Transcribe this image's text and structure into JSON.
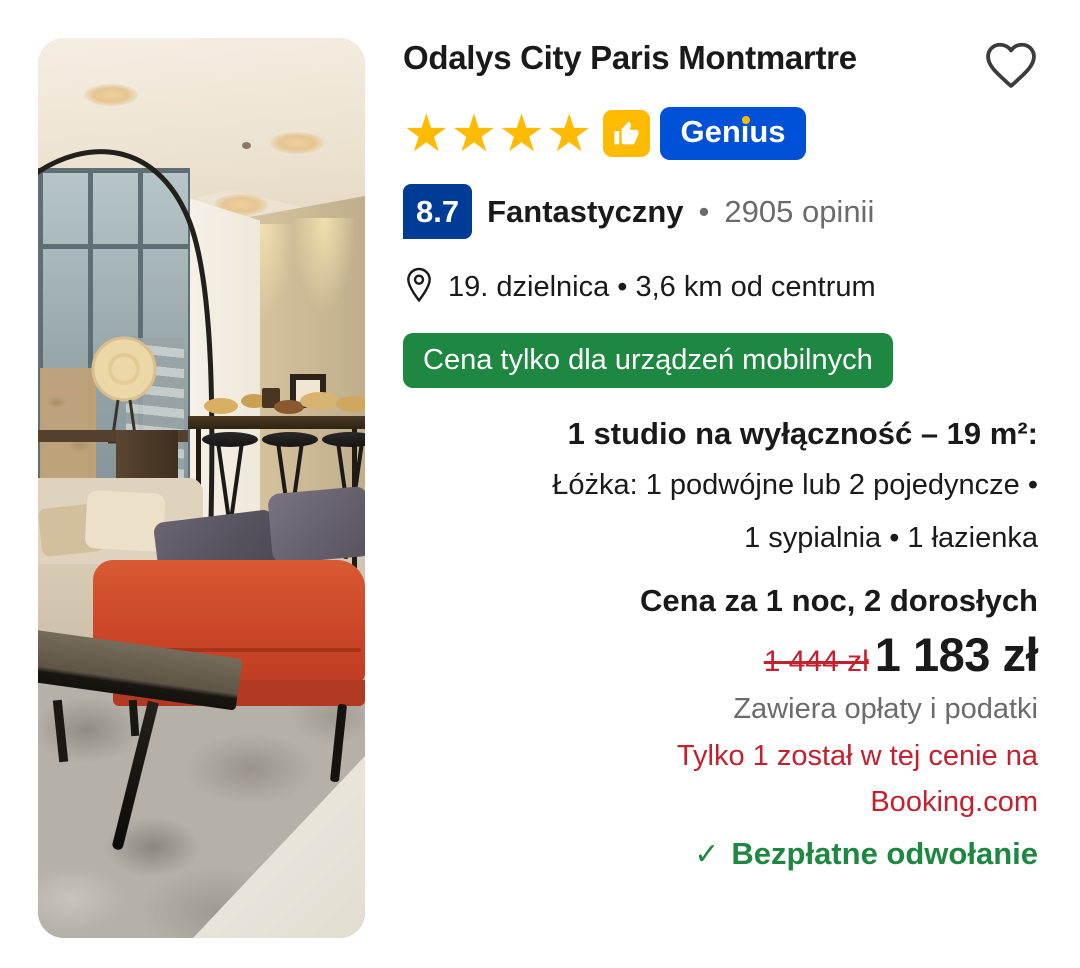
{
  "card": {
    "title": "Odalys City Paris Montmartre",
    "stars_text": "★★★★",
    "genius": {
      "label": "Genius"
    },
    "rating": {
      "score": "8.7",
      "label": "Fantastyczny",
      "separator": "•",
      "reviews": "2905 opinii"
    },
    "location": {
      "text": "19. dzielnica • 3,6 km od centrum"
    },
    "deal_badge": {
      "text": "Cena tylko dla urządzeń mobilnych"
    },
    "room": {
      "headline": "1 studio na wyłączność – 19 m²:",
      "beds_line": "Łóżka: 1 podwójne lub 2 pojedyncze •",
      "rooms_line": "1 sypialnia • 1 łazienka"
    },
    "price": {
      "label": "Cena za 1 noc, 2 dorosłych",
      "original": "1 444 zł",
      "current": "1 183 zł",
      "taxes_note": "Zawiera opłaty i podatki",
      "urgency_line1": "Tylko 1 został w tej cenie na",
      "urgency_line2": "Booking.com",
      "check_glyph": "✓",
      "cancellation": "Bezpłatne odwołanie"
    }
  },
  "colors": {
    "star_yellow": "#febb02",
    "genius_blue": "#0050d8",
    "rating_badge_blue": "#003b95",
    "deal_green": "#1e8741",
    "cancellation_green": "#1e8741",
    "urgency_red": "#c4202e",
    "old_price_red": "#c4202e",
    "text_dark": "#1a1a1a",
    "text_gray": "#6b6b6b"
  },
  "icons": {
    "wishlist": "heart-icon",
    "genius_thumb": "thumbs-up-icon",
    "location": "location-pin-icon",
    "free_cancellation": "check-icon"
  }
}
